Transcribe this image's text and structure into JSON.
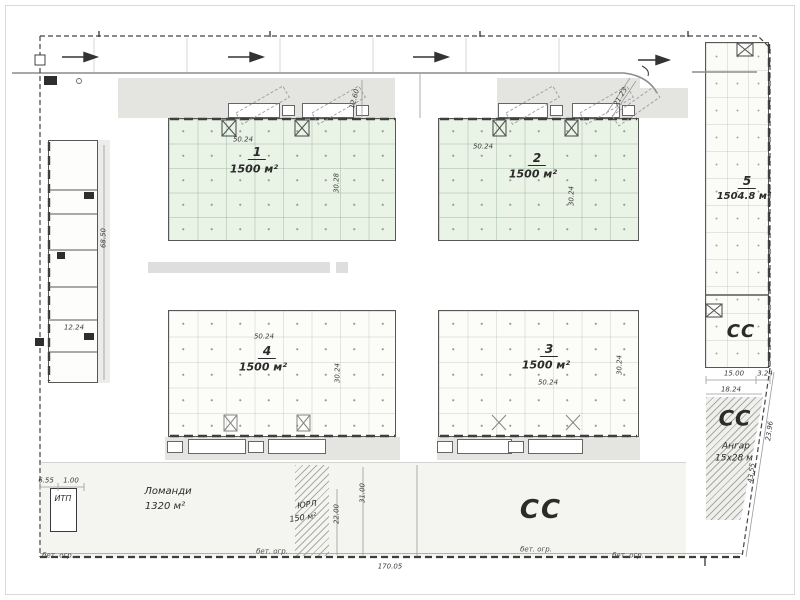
{
  "buildings": {
    "b1": {
      "number": "1",
      "area": "1500 м²",
      "top_dim": "50.24",
      "side_dim": "30.28"
    },
    "b2": {
      "number": "2",
      "area": "1500 м²",
      "top_dim": "50.24",
      "side_dim": "30.24"
    },
    "b3": {
      "number": "3",
      "area": "1500 м²",
      "bottom_dim": "50.24",
      "side_dim": "30.24"
    },
    "b4": {
      "number": "4",
      "area": "1500 м²",
      "top_dim": "50.24",
      "side_dim": "30.24"
    },
    "b5": {
      "number": "5",
      "area": "1504.8 м²"
    }
  },
  "zones": {
    "yard_cc": "СС",
    "b5_cc": "СС",
    "hangar": {
      "cc": "СС",
      "name": "Ангар",
      "size": "15х28 м"
    },
    "lomandi": {
      "name": "Ломанди",
      "area": "1320 м²"
    },
    "yurl": {
      "name": "ЮРЛ",
      "area": "150 м²"
    },
    "itp": "ИТП"
  },
  "dims": {
    "left_width": "12.24",
    "left_length": "68.50",
    "dock_depth": "12.60",
    "entry": "21.23",
    "hangar_len": "15.00",
    "hangar_gap": "3.24",
    "hangar_width": "18.24",
    "slant_outer": "23.96",
    "slant_inner": "43.55",
    "site_length": "170.05",
    "yurl_len1": "31.00",
    "yurl_len2": "22.00",
    "itp_width": "6.55",
    "itp_gap": "1.00"
  },
  "fence": {
    "f1": "бет. огр.",
    "f2": "бет. огр.",
    "f3": "бет. огр.",
    "f4": "бет. огр."
  }
}
